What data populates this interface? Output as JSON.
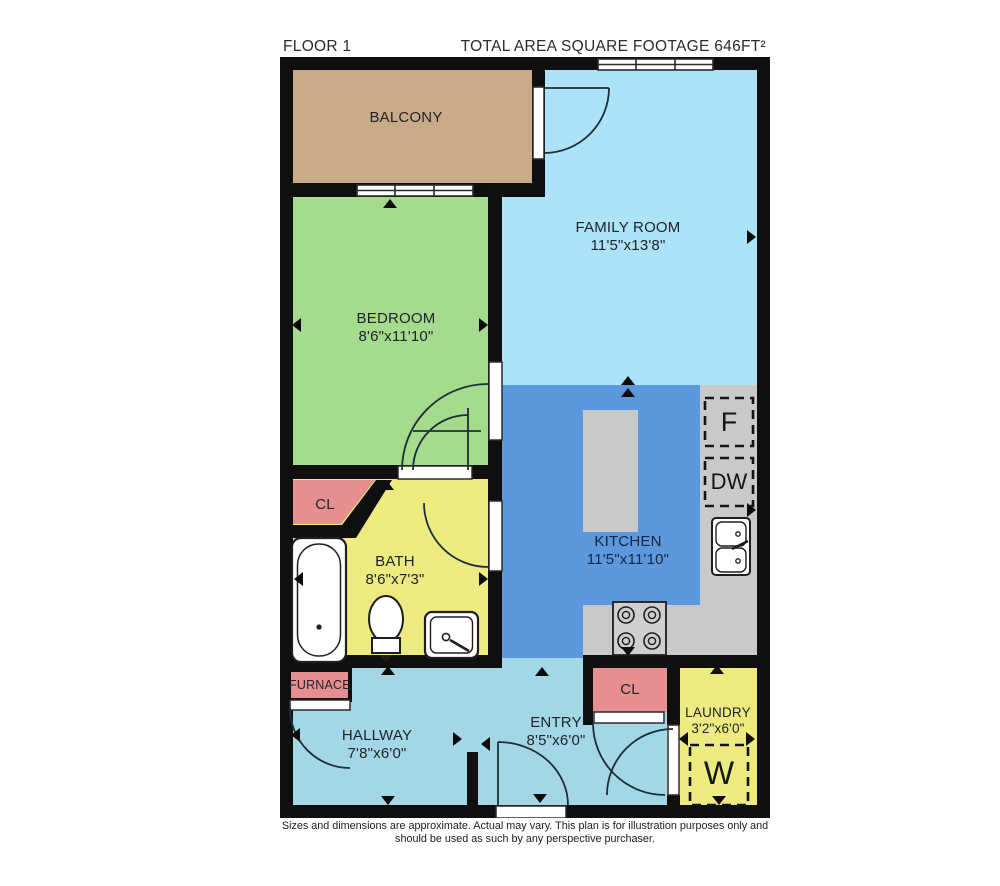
{
  "header": {
    "floor_label": "FLOOR 1",
    "total_area_label": "TOTAL AREA SQUARE FOOTAGE 646FT²"
  },
  "rooms": {
    "balcony": {
      "name": "BALCONY"
    },
    "family_room": {
      "name": "FAMILY ROOM",
      "dimensions": "11'5\"x13'8\""
    },
    "bedroom": {
      "name": "BEDROOM",
      "dimensions": "8'6\"x11'10\""
    },
    "kitchen": {
      "name": "KITCHEN",
      "dimensions": "11'5\"x11'10\""
    },
    "bath": {
      "name": "BATH",
      "dimensions": "8'6\"x7'3\""
    },
    "bedroom_closet": {
      "name": "CL"
    },
    "entry_closet": {
      "name": "CL"
    },
    "furnace": {
      "name": "FURNACE"
    },
    "hallway": {
      "name": "HALLWAY",
      "dimensions": "7'8\"x6'0\""
    },
    "entry": {
      "name": "ENTRY",
      "dimensions": "8'5\"x6'0\""
    },
    "laundry": {
      "name": "LAUNDRY",
      "dimensions": "3'2\"x6'0\""
    }
  },
  "appliances": {
    "fridge_label": "F",
    "dishwasher_label": "DW",
    "washer_label": "W"
  },
  "footer": {
    "line1": "Sizes and dimensions are approximate. Actual may vary. This plan is for illustration purposes only and",
    "line2": "should be used as such by any perspective purchaser."
  },
  "colors": {
    "wall": "#0f0f0f",
    "balcony": "#c9ab89",
    "family_room": "#ace3f8",
    "bedroom": "#a4db8d",
    "kitchen": "#5b98dc",
    "bath": "#edea80",
    "closet": "#e68f90",
    "hallway": "#a3d7e6",
    "counter": "#c9c9c9"
  }
}
